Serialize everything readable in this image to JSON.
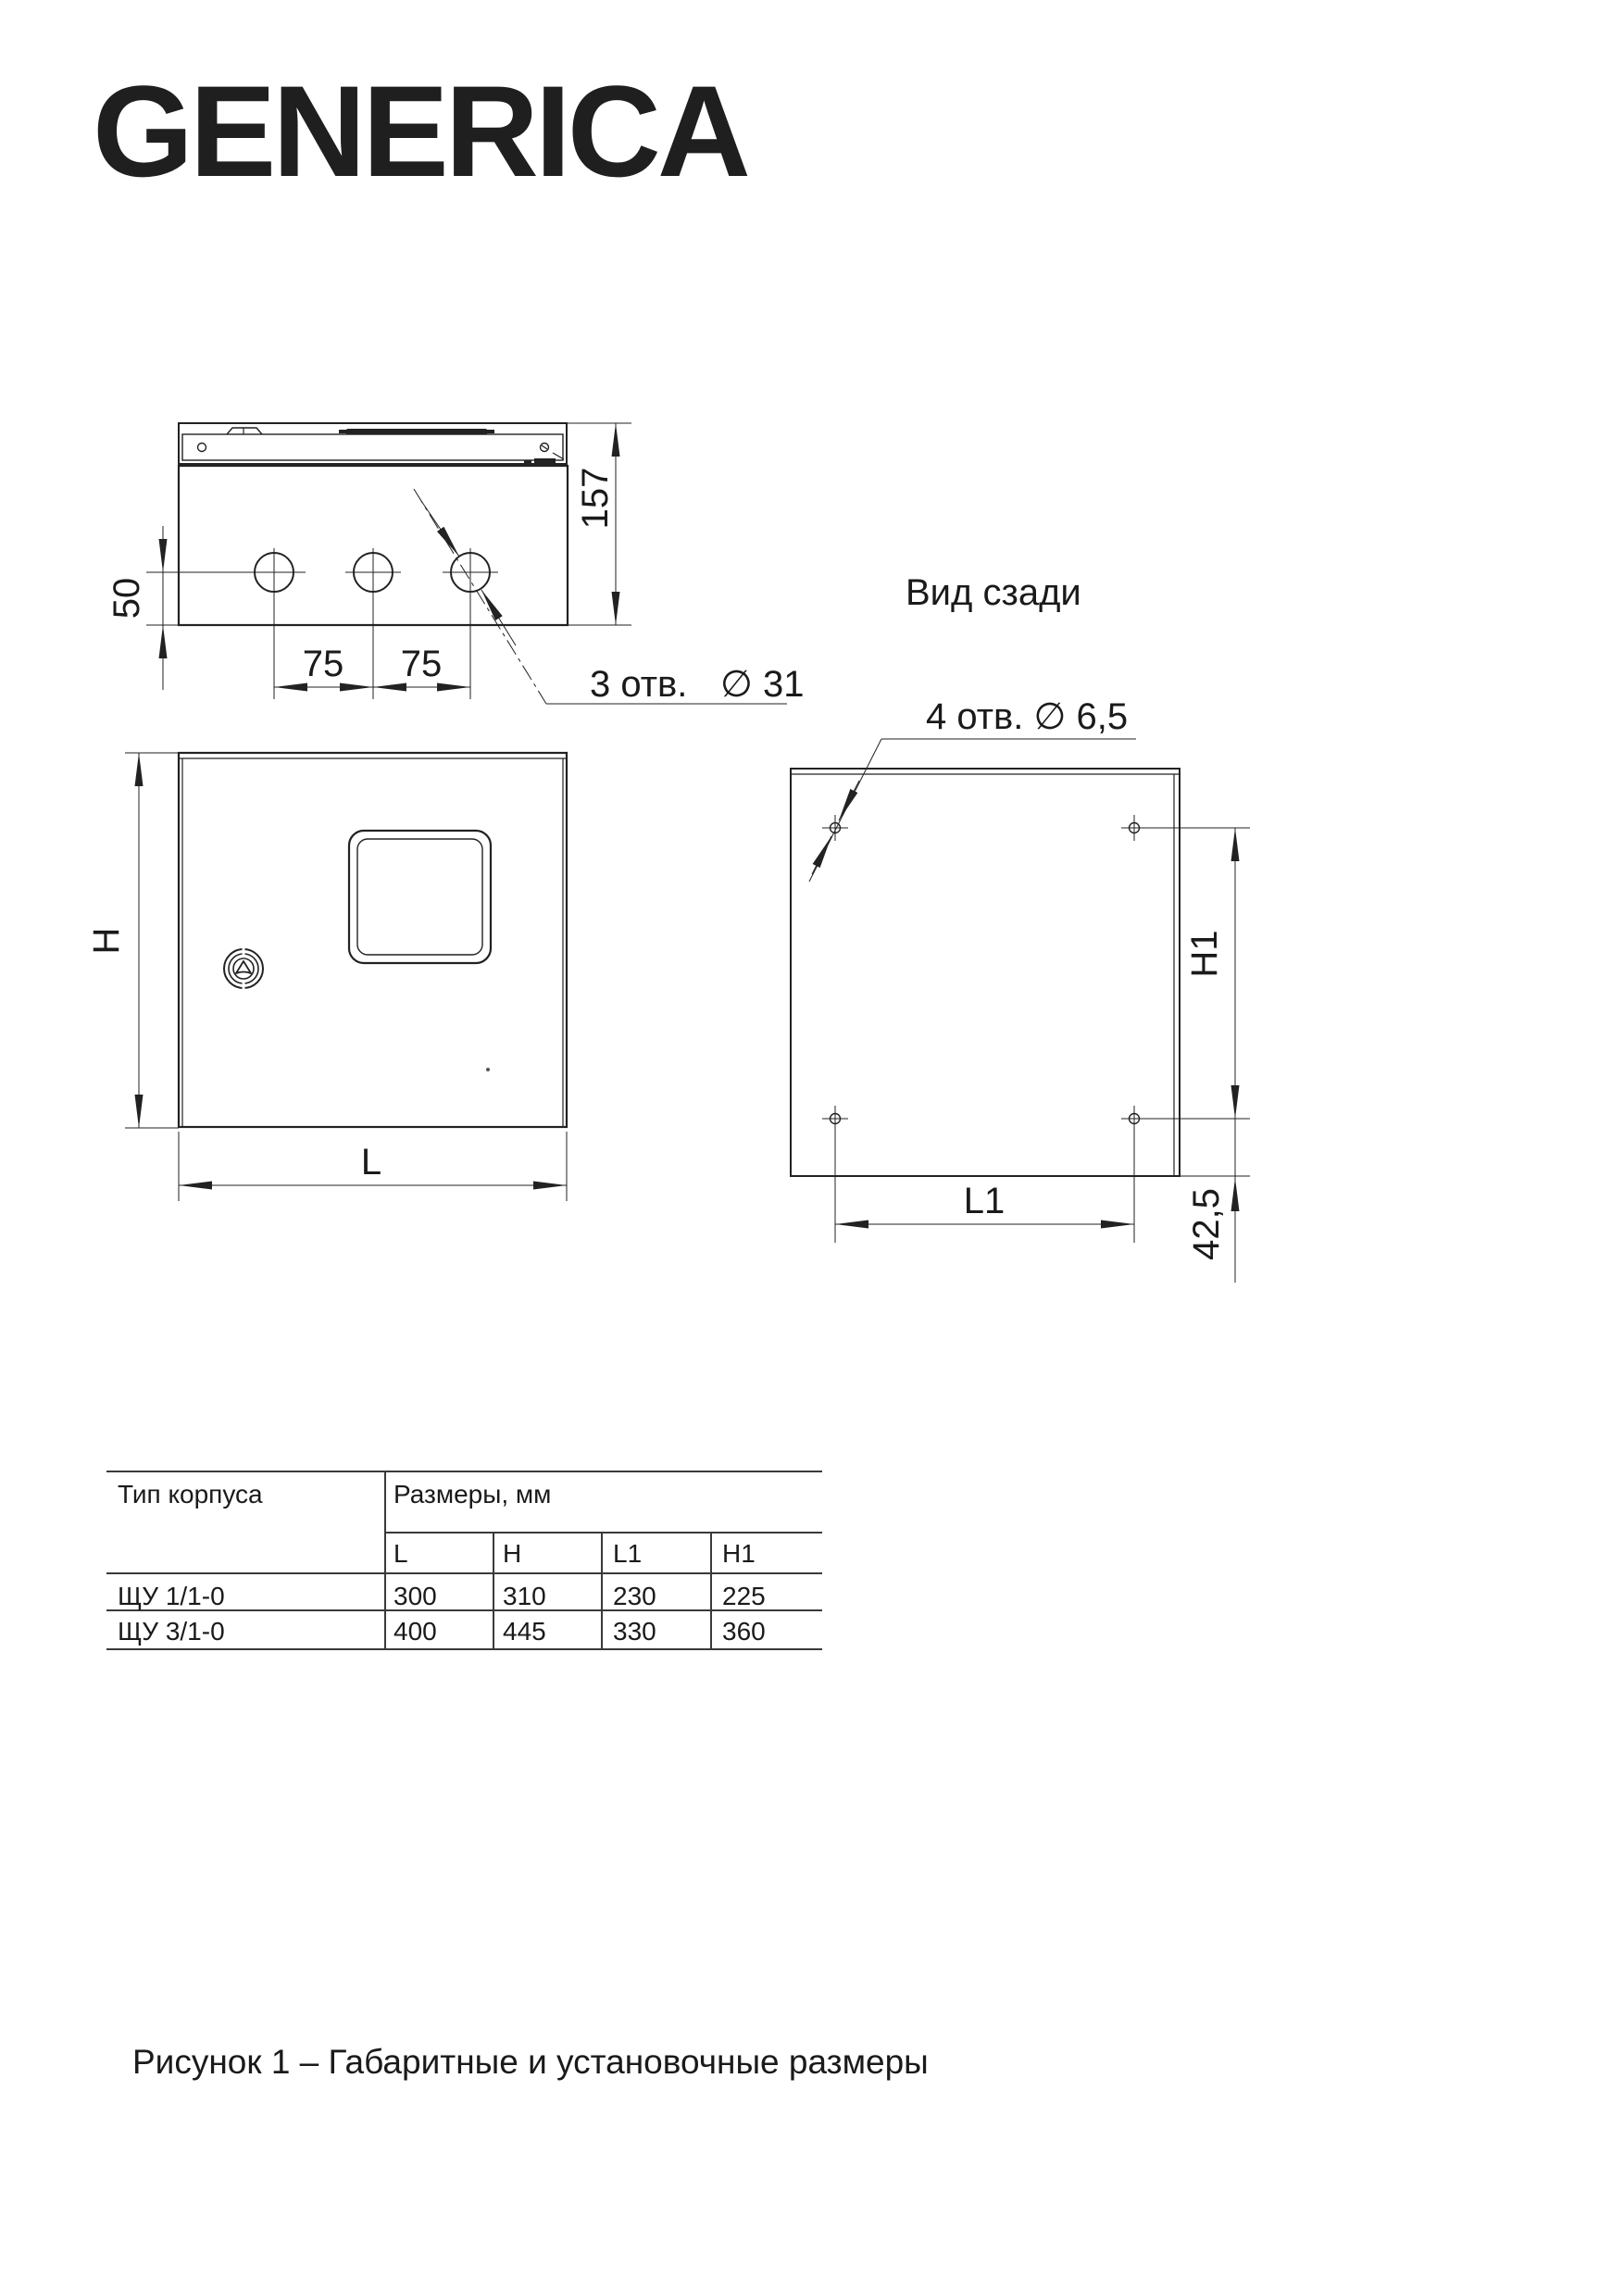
{
  "brand": {
    "logo_text": "GENERICA"
  },
  "drawing": {
    "top_view": {
      "dim_depth": "157",
      "dim_hole_offset": "50",
      "dim_spacing_left": "75",
      "dim_spacing_right": "75",
      "callout_count": "3 отв.",
      "callout_diameter": "∅ 31"
    },
    "front_view": {
      "dim_height": "H",
      "dim_width": "L"
    },
    "rear_view": {
      "title": "Вид сзади",
      "callout": "4 отв. ∅ 6,5",
      "dim_height": "H1",
      "dim_width": "L1",
      "dim_bottom_offset": "42,5"
    }
  },
  "table": {
    "col_type_header": "Тип корпуса",
    "col_sizes_header": "Размеры, мм",
    "sub_headers": [
      "L",
      "H",
      "L1",
      "H1"
    ],
    "rows": [
      {
        "type": "ЩУ 1/1-0",
        "values": [
          "300",
          "310",
          "230",
          "225"
        ]
      },
      {
        "type": "ЩУ 3/1-0",
        "values": [
          "400",
          "445",
          "330",
          "360"
        ]
      }
    ]
  },
  "caption": "Рисунок 1 – Габаритные и установочные размеры",
  "colors": {
    "line": "#222222",
    "text": "#1a1a1a",
    "background": "#ffffff"
  }
}
